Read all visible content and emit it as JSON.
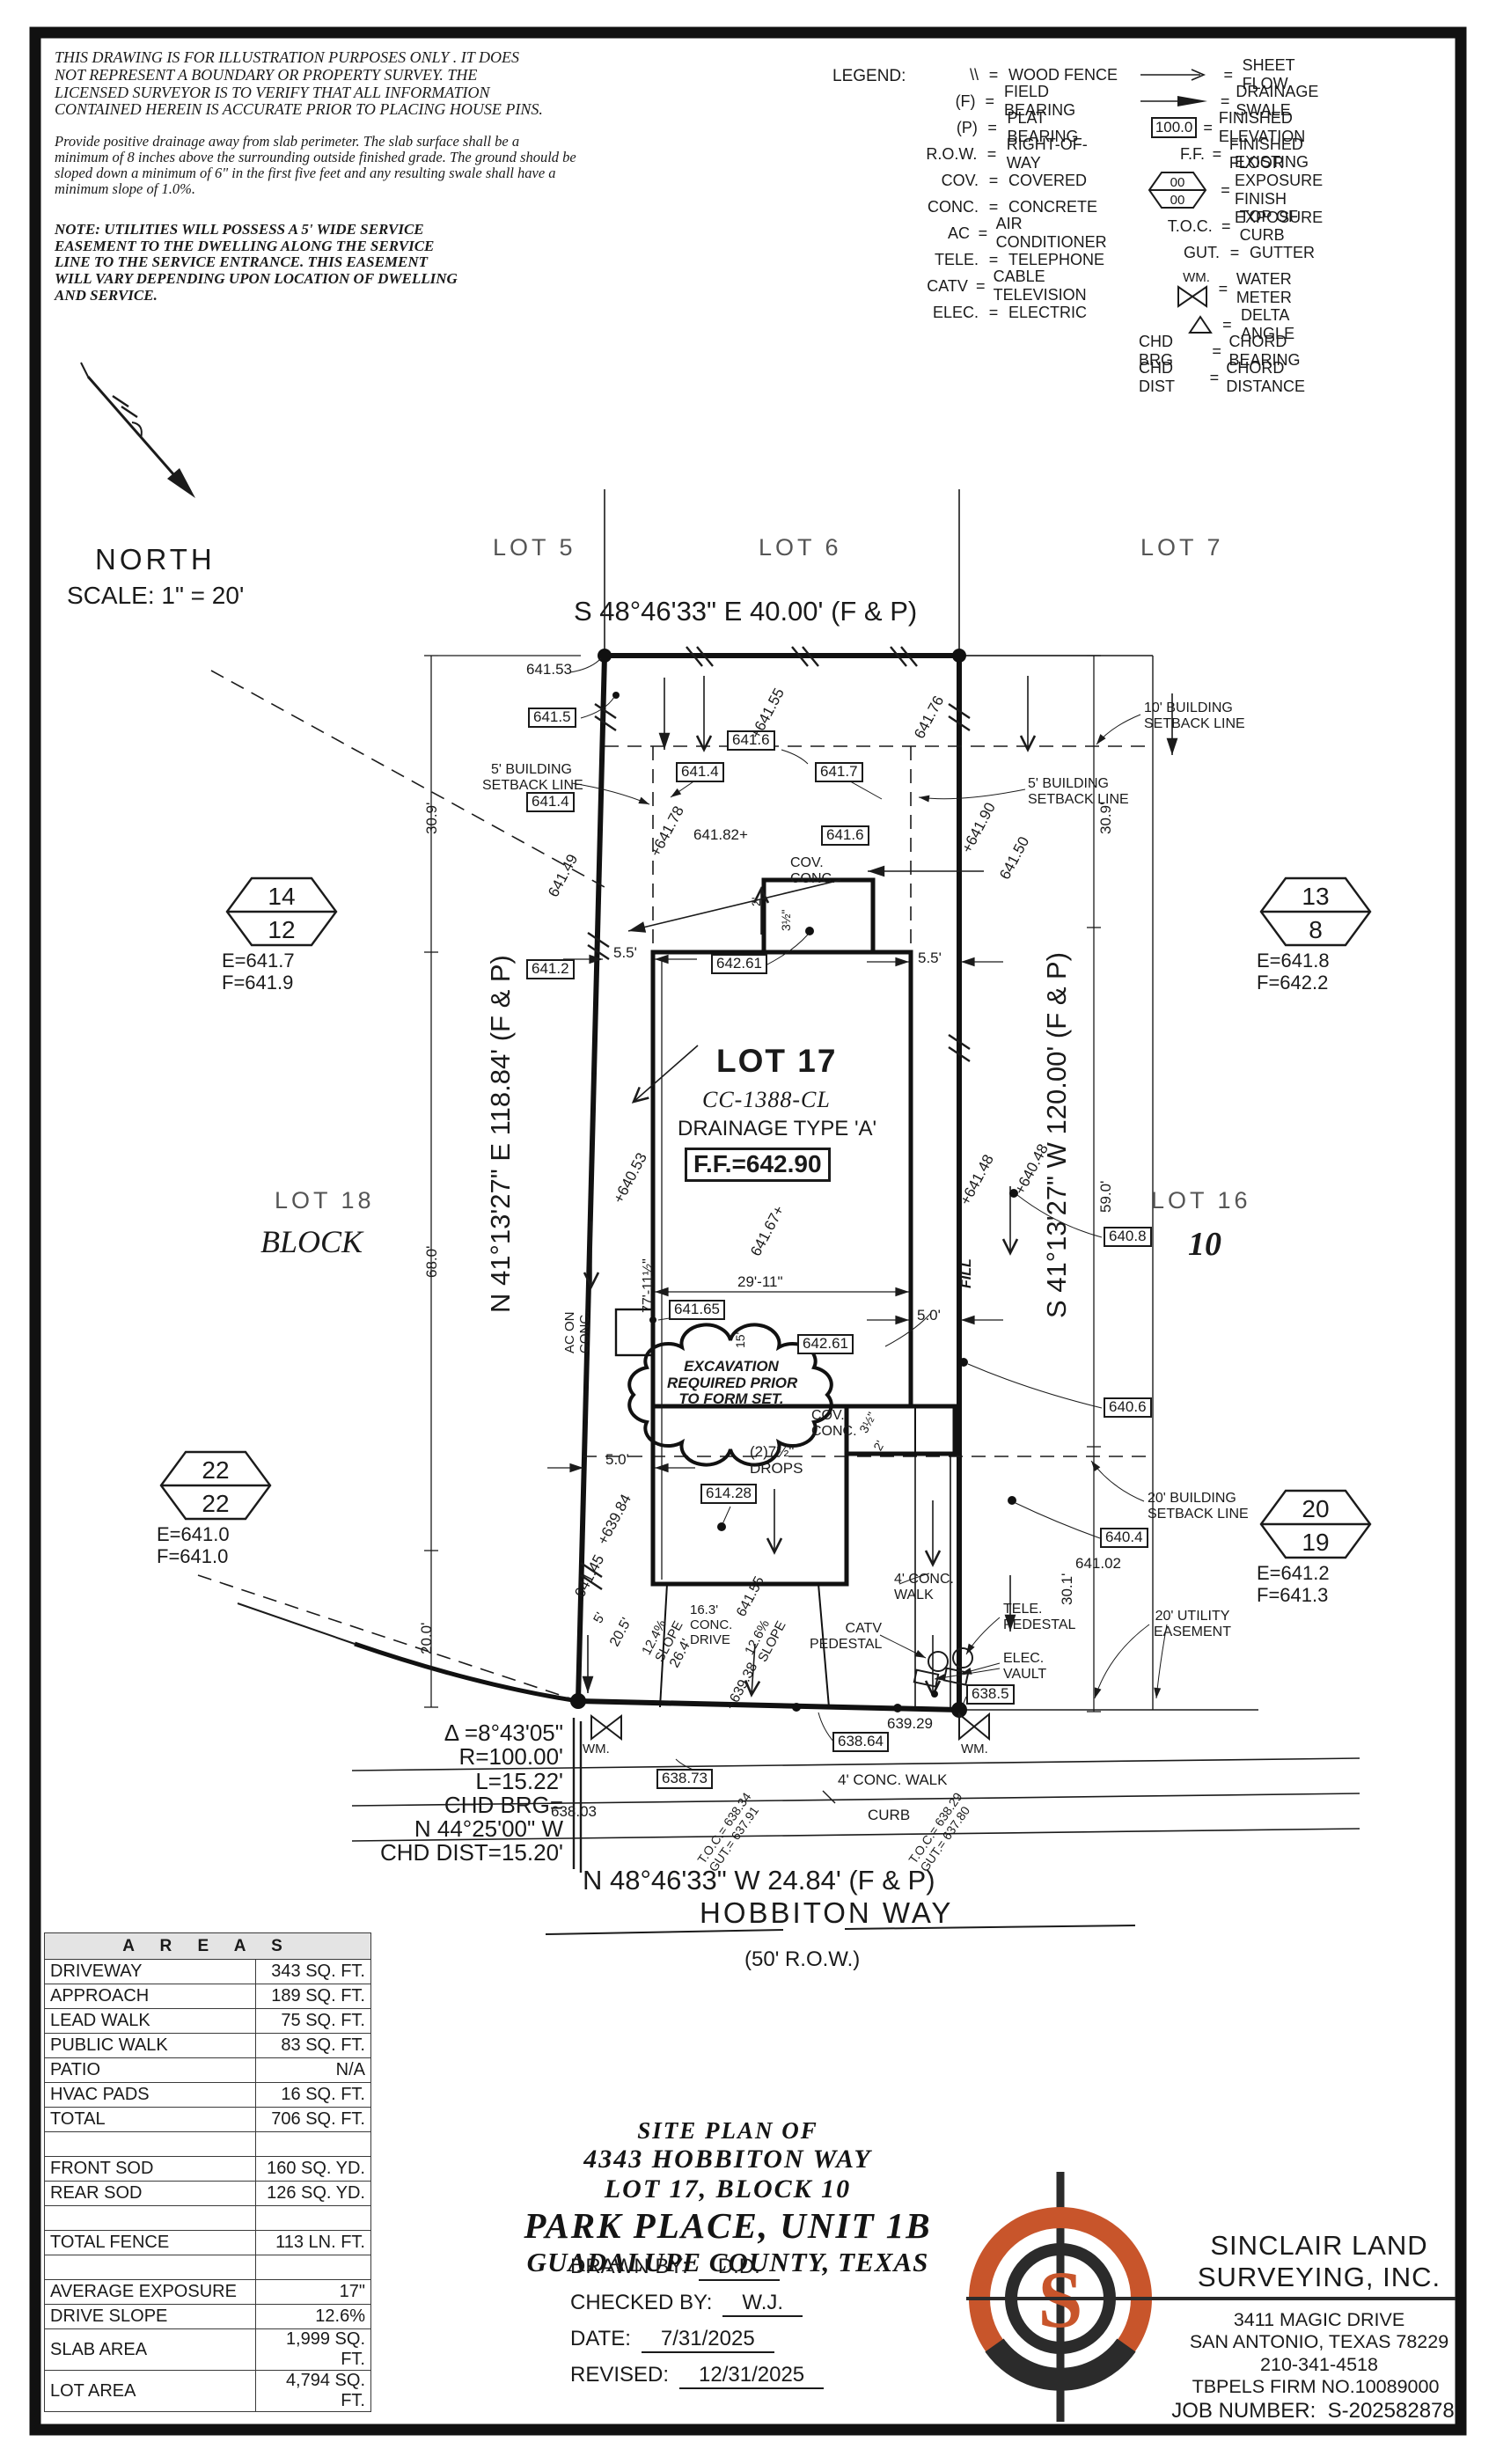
{
  "notes": {
    "disclaimer_lines": [
      "THIS DRAWING IS FOR ILLUSTRATION PURPOSES ONLY . IT DOES",
      "NOT REPRESENT A BOUNDARY OR PROPERTY SURVEY. THE",
      "LICENSED SURVEYOR IS TO VERIFY THAT ALL INFORMATION",
      "CONTAINED HEREIN IS ACCURATE PRIOR TO PLACING HOUSE PINS."
    ],
    "drainage_lines": [
      "Provide positive drainage away from slab perimeter. The slab surface shall be a",
      "minimum of 8 inches above the surrounding outside finished grade. The ground should be",
      "sloped down a minimum of 6\" in the first five feet and any resulting swale shall have a",
      "minimum slope of 1.0%."
    ],
    "utility_lines": [
      "NOTE: UTILITIES WILL POSSESS A 5' WIDE SERVICE",
      "EASEMENT TO THE DWELLING ALONG THE SERVICE",
      "LINE TO THE SERVICE ENTRANCE. THIS EASEMENT",
      "WILL VARY DEPENDING UPON LOCATION OF DWELLING",
      "AND SERVICE."
    ]
  },
  "legend": {
    "title": "LEGEND:",
    "left": [
      {
        "sym": "\\\\",
        "label": "WOOD FENCE"
      },
      {
        "sym": "(F)",
        "label": "FIELD BEARING"
      },
      {
        "sym": "(P)",
        "label": "PLAT BEARING"
      },
      {
        "sym": "R.O.W.",
        "label": "RIGHT-OF-WAY"
      },
      {
        "sym": "COV.",
        "label": "COVERED"
      },
      {
        "sym": "CONC.",
        "label": "CONCRETE"
      },
      {
        "sym": "AC",
        "label": "AIR CONDITIONER"
      },
      {
        "sym": "TELE.",
        "label": "TELEPHONE"
      },
      {
        "sym": "CATV",
        "label": "CABLE TELEVISION"
      },
      {
        "sym": "ELEC.",
        "label": "ELECTRIC"
      }
    ],
    "right": [
      {
        "label": "SHEET FLOW"
      },
      {
        "label": "DRAINAGE SWALE"
      },
      {
        "sym": "100.0",
        "label": "FINISHED ELEVATION"
      },
      {
        "sym": "F.F.",
        "label": "FINISHED FLOOR"
      },
      {
        "hex_top": "00",
        "hex_bottom": "00",
        "label": "EXISTING EXPOSURE",
        "label2": "FINISH EXPOSURE"
      },
      {
        "sym": "T.O.C.",
        "label": "TOP OF CURB"
      },
      {
        "sym": "GUT.",
        "label": "GUTTER"
      },
      {
        "sym": "WM.",
        "label": "WATER METER"
      },
      {
        "label": "DELTA ANGLE"
      },
      {
        "sym": "CHD BRG",
        "label": "CHORD BEARING"
      },
      {
        "sym": "CHD DIST",
        "label": "CHORD DISTANCE"
      }
    ]
  },
  "north": {
    "label": "NORTH",
    "scale": "SCALE: 1\" = 20'"
  },
  "plat": {
    "lot5": "LOT 5",
    "lot6": "LOT 6",
    "lot7": "LOT 7",
    "lot18": "LOT 18",
    "block_left": "BLOCK",
    "lot16": "LOT 16",
    "block_right": "10",
    "bearing_top": "S 48°46'33\" E 40.00' (F & P)",
    "bearing_left": "N 41°13'27\" E 118.84' (F & P)",
    "bearing_right": "S 41°13'27\" W 120.00' (F & P)",
    "bearing_bottom": "N 48°46'33\" W 24.84' (F & P)",
    "street_name": "HOBBITON WAY",
    "street_row": "(50' R.O.W.)",
    "lot_title": "LOT 17",
    "lot_code": "CC-1388-CL",
    "lot_drainage": "DRAINAGE TYPE 'A'",
    "ff_label": "F.F.=642.90",
    "cloud": [
      "EXCAVATION",
      "REQUIRED PRIOR",
      "TO FORM SET."
    ],
    "curve": {
      "delta": "Δ =8°43'05\"",
      "radius": "R=100.00'",
      "length": "L=15.22'",
      "chd1": "CHD BRG=",
      "chd2": "N 44°25'00\" W",
      "chd3": "CHD DIST=15.20'"
    },
    "setbacks": {
      "five": [
        "5' BUILDING",
        "SETBACK LINE"
      ],
      "ten": [
        "10' BUILDING",
        "SETBACK LINE"
      ],
      "twenty": [
        "20' BUILDING",
        "SETBACK LINE"
      ],
      "utility": [
        "20' UTILITY",
        "EASEMENT"
      ]
    },
    "hex_markers": [
      {
        "top": "14",
        "bottom": "12",
        "e": "E=641.7",
        "f": "F=641.9"
      },
      {
        "top": "13",
        "bottom": "8",
        "e": "E=641.8",
        "f": "F=642.2"
      },
      {
        "top": "22",
        "bottom": "22",
        "e": "E=641.0",
        "f": "F=641.0"
      },
      {
        "top": "20",
        "bottom": "19",
        "e": "E=641.2",
        "f": "F=641.3"
      }
    ],
    "ann": {
      "e64153": "641.53",
      "b6415": "641.5",
      "b6416_top": "641.6",
      "e64155_top": "+641.55",
      "e64176": "641.76",
      "b6414_a": "641.4",
      "b6417": "641.7",
      "b6414_b": "641.4",
      "e64178": "+641.78",
      "e64149": "641.49",
      "e64182": "641.82+",
      "b6416_mid": "641.6",
      "e64190": "+641.90",
      "e64150": "641.50",
      "cov1": "COV.",
      "cov2": "CONC.",
      "d2ft": "2'",
      "d35": "3½\"",
      "d55l": "5.5'",
      "d55r": "5.5'",
      "b6412": "641.2",
      "b64261_top": "642.61",
      "e64053": "+640.53",
      "e64167": "641.67+",
      "e64148": "+641.48",
      "e64048": "+640.48",
      "b6408": "640.8",
      "fill": "FILL",
      "ac1": "AC ON",
      "ac2": "CONC.",
      "dhw": "77'-11½\"",
      "d2911": "29'-11\"",
      "b64165": "641.65",
      "d15": "15\"",
      "b64261_mid": "642.61",
      "d50r": "5.0'",
      "d50l": "5.0'",
      "b6406": "640.6",
      "drops1": "(2)7½\"",
      "drops2": "DROPS",
      "b61428": "614.28",
      "e63984": "+639.84",
      "e64145": "641.45",
      "b6404": "640.4",
      "e64102": "641.02",
      "walk4": "4' CONC.",
      "walk4b": "WALK",
      "d5": "5'",
      "d205": "20.5'",
      "slope124a": "12.4%",
      "slope124b": "SLOPE",
      "d264": "26.4'",
      "drive1": "16.3'",
      "drive2": "CONC.",
      "drive3": "DRIVE",
      "slope126a": "12.6%",
      "slope126b": "SLOPE",
      "e64155_b": "641.55",
      "e63938": "+639.38",
      "catv1": "CATV",
      "catv2": "PEDESTAL",
      "tele1": "TELE.",
      "tele2": "PEDESTAL",
      "elec1": "ELEC.",
      "elec2": "VAULT",
      "b6385": "638.5",
      "e63929": "639.29",
      "b63864": "638.64",
      "e63803": "638.03",
      "b63873": "638.73",
      "wm": "WM.",
      "walk_bottom": "4' CONC. WALK",
      "curb": "CURB",
      "tocl1": "T.O.C.= 638.34",
      "tocl2": "GUT.= 637.91",
      "tocr1": "T.O.C.= 638.29",
      "tocr2": "GUT.= 637.80",
      "d309l": "30.9'",
      "d309r": "30.9'",
      "d680": "68.0'",
      "d590": "59.0'",
      "d200": "20.0'",
      "d301": "30.1'"
    }
  },
  "areas": {
    "title": "A R E A S",
    "rows": [
      {
        "label": "DRIVEWAY",
        "value": "343 SQ. FT."
      },
      {
        "label": "APPROACH",
        "value": "189 SQ. FT."
      },
      {
        "label": "LEAD WALK",
        "value": "75 SQ. FT."
      },
      {
        "label": "PUBLIC WALK",
        "value": "83 SQ. FT."
      },
      {
        "label": "PATIO",
        "value": "N/A"
      },
      {
        "label": "HVAC PADS",
        "value": "16 SQ. FT."
      },
      {
        "label": "TOTAL",
        "value": "706 SQ. FT."
      },
      {
        "label": "",
        "value": ""
      },
      {
        "label": "FRONT SOD",
        "value": "160 SQ. YD."
      },
      {
        "label": "REAR SOD",
        "value": "126 SQ. YD."
      },
      {
        "label": "",
        "value": ""
      },
      {
        "label": "TOTAL FENCE",
        "value": "113 LN. FT."
      },
      {
        "label": "",
        "value": ""
      },
      {
        "label": "AVERAGE EXPOSURE",
        "value": "17\""
      },
      {
        "label": "DRIVE SLOPE",
        "value": "12.6%"
      },
      {
        "label": "SLAB AREA",
        "value": "1,999 SQ. FT."
      },
      {
        "label": "LOT AREA",
        "value": "4,794 SQ. FT."
      }
    ]
  },
  "title_block": {
    "line1": "SITE PLAN OF",
    "line2": "4343 HOBBITON WAY",
    "line3": "LOT 17, BLOCK 10",
    "line4": "PARK PLACE, UNIT 1B",
    "line5": "GUADALUPE COUNTY, TEXAS",
    "drawn_label": "DRAWN BY:",
    "drawn": "D.D.",
    "checked_label": "CHECKED BY:",
    "checked": "W.J.",
    "date_label": "DATE:",
    "date": "7/31/2025",
    "revised_label": "REVISED:",
    "revised": "12/31/2025"
  },
  "firm": {
    "name1": "SINCLAIR LAND",
    "name2": "SURVEYING, INC.",
    "addr1": "3411 MAGIC DRIVE",
    "addr2": "SAN ANTONIO, TEXAS 78229",
    "phone": "210-341-4518",
    "firm_no": "TBPELS FIRM NO.10089000",
    "job_label": "JOB NUMBER:",
    "job": "S-202582878",
    "logo_letter": "S",
    "logo_orange": "#c8552b",
    "logo_black": "#2b2b2b"
  }
}
